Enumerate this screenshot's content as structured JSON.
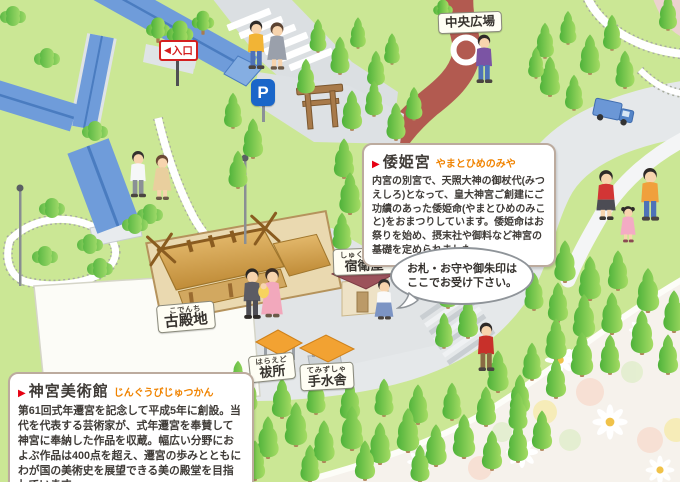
{
  "labels": {
    "central_plaza": "中央広場",
    "kodenchi": {
      "ruby": "こでんち",
      "text": "古殿地"
    },
    "shukueiya": {
      "ruby": "しゅくえいや",
      "text": "宿衛屋"
    },
    "haraedo": {
      "ruby": "はらえど",
      "text": "祓所"
    },
    "temizusha": {
      "ruby": "てみずしゃ",
      "text": "手水舎"
    }
  },
  "signs": {
    "entrance_arrow": "◀",
    "entrance": "入口",
    "parking": "P"
  },
  "info_boxes": {
    "yamatohime": {
      "marker": "▶",
      "title": "倭姫宮",
      "ruby": "やまとひめのみや",
      "body": "内宮の別宮で、天照大神の御杖代(みつえしろ)となって、皇大神宮ご創建にご功績のあった倭姫命(やまとひめのみこと)をおまつりしています。倭姫命はお祭りを始め、摂末社や御料など神宮の基礎を定められました。"
    },
    "museum": {
      "marker": "▶",
      "title": "神宮美術館",
      "ruby": "じんぐうびじゅつかん",
      "body": "第61回式年遷宮を記念して平成5年に創設。当代を代表する芸術家が、式年遷宮を奉賛して神宮に奉納した作品を収蔵。幅広い分野におよぶ作品は400点を超え、遷宮の歩みとともにわが国の美術史を展望できる美の殿堂を目指しています。"
    }
  },
  "speech_bubble": {
    "line1": "お札・お守や御朱印は",
    "line2": "ここでお受け下さい。"
  },
  "colors": {
    "grass": "#cbe795",
    "roof_blue": "#6f9cda",
    "path_red": "#b25a50",
    "accent_red": "#e60012",
    "ruby_orange": "#f08300",
    "parking_blue": "#1a66c9",
    "shed_orange": "#f2a232"
  }
}
